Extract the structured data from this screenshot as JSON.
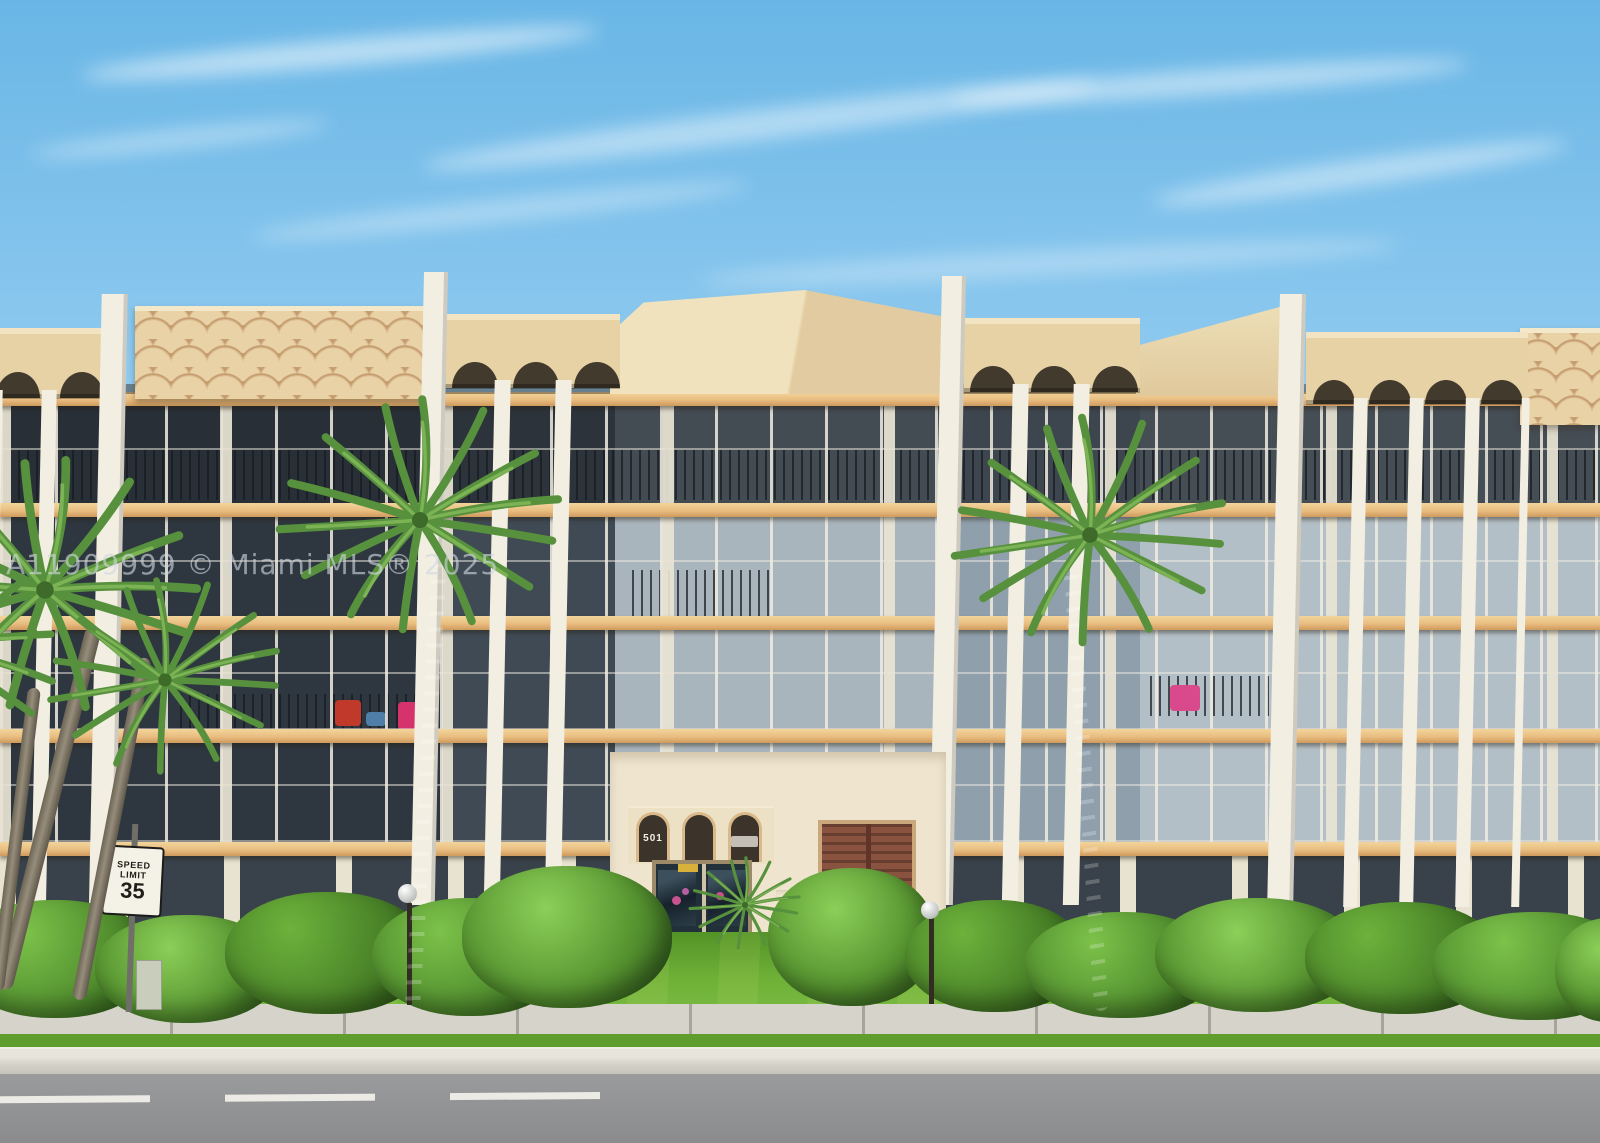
{
  "photo": {
    "type": "real-estate-listing-photograph",
    "watermark": "A11909999 © Miami MLS® 2025",
    "speed_limit_sign": {
      "line1": "SPEED",
      "line2": "LIMIT",
      "value": "35"
    },
    "entrance": {
      "address": "501"
    },
    "palette": {
      "sky_top": "#69b6e6",
      "sky_bottom": "#d3ecf8",
      "cloud_white": "#ffffff",
      "roof_tan": "#e7d2a6",
      "roof_scale_shadow": "#c8a77a",
      "concrete_white": "#f2eee1",
      "glass_dark": "#2e3740",
      "glass_light": "#b3bfc7",
      "floor_band_tan": "#e9bd80",
      "hedge_green": "#4e8a2c",
      "grass_green": "#6fb037",
      "palm_green": "#57913d",
      "trunk_gray": "#b3aa98",
      "sidewalk_gray": "#d6d4ca",
      "road_gray": "#9a9b9d",
      "brick_terracotta": "#b5744c",
      "shutter_brown": "#8a5340",
      "entrance_wall_cream": "#efe5cf"
    }
  }
}
